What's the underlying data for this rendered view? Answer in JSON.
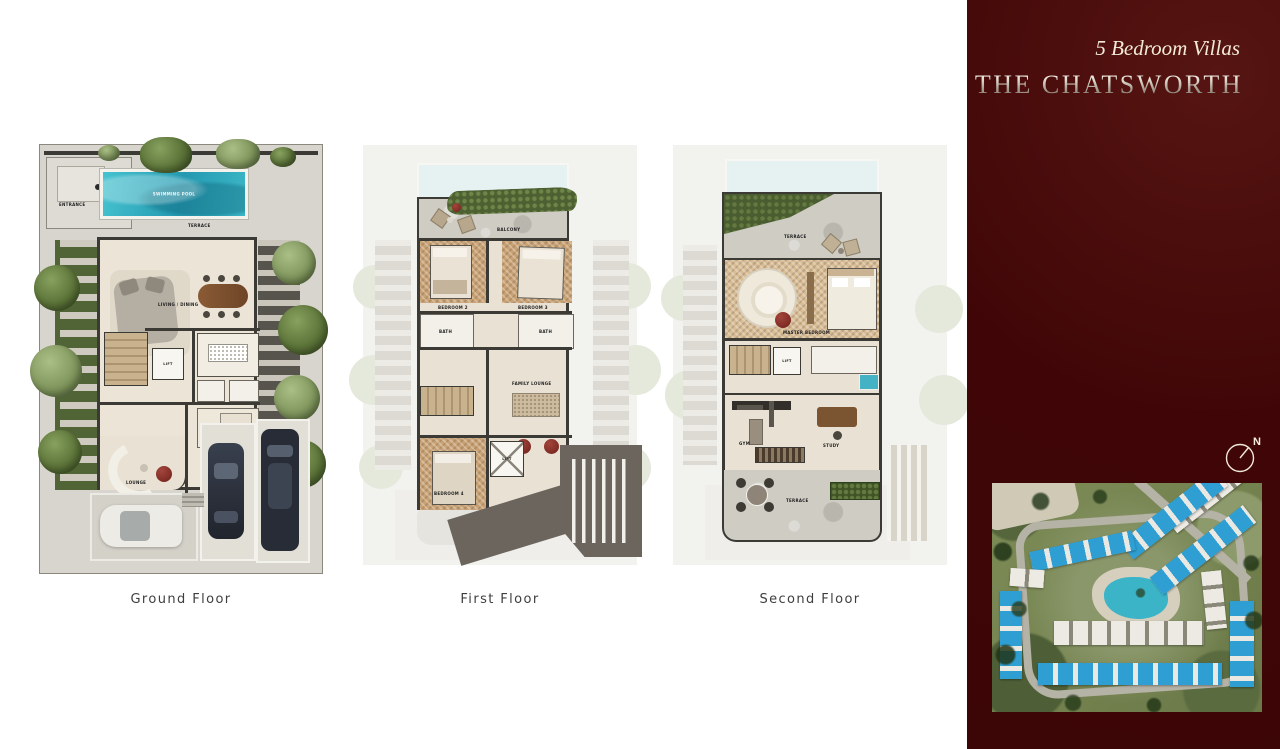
{
  "header": {
    "subtitle": "5 Bedroom Villas",
    "title": "THE CHATSWORTH"
  },
  "floors": [
    {
      "label": "Ground Floor"
    },
    {
      "label": "First Floor"
    },
    {
      "label": "Second Floor"
    }
  ],
  "compass": {
    "north_label": "N"
  },
  "room_labels": {
    "g_pool": "SWIMMING POOL",
    "g_terrace": "TERRACE",
    "g_living": "LIVING / DINING",
    "g_lift": "LIFT",
    "g_lounge": "LOUNGE",
    "g_entrance": "ENTRANCE",
    "f_balcony": "BALCONY",
    "f_bed2": "BEDROOM 2",
    "f_bed3": "BEDROOM 3",
    "f_bed4": "BEDROOM 4",
    "f_bath": "BATH",
    "f_family": "FAMILY LOUNGE",
    "f_lift": "LIFT",
    "s_terrace": "TERRACE",
    "s_master": "MASTER BEDROOM",
    "s_gym": "GYM",
    "s_study": "STUDY",
    "s_lift": "LIFT",
    "s_terrace2": "TERRACE"
  },
  "colors": {
    "sidebar_maroon": "#400607",
    "pool_turquoise": "#38b4c6",
    "roof_blue": "#2f9ed2",
    "greenery_green": "#516435",
    "title_silver": "#cdc5ba"
  }
}
